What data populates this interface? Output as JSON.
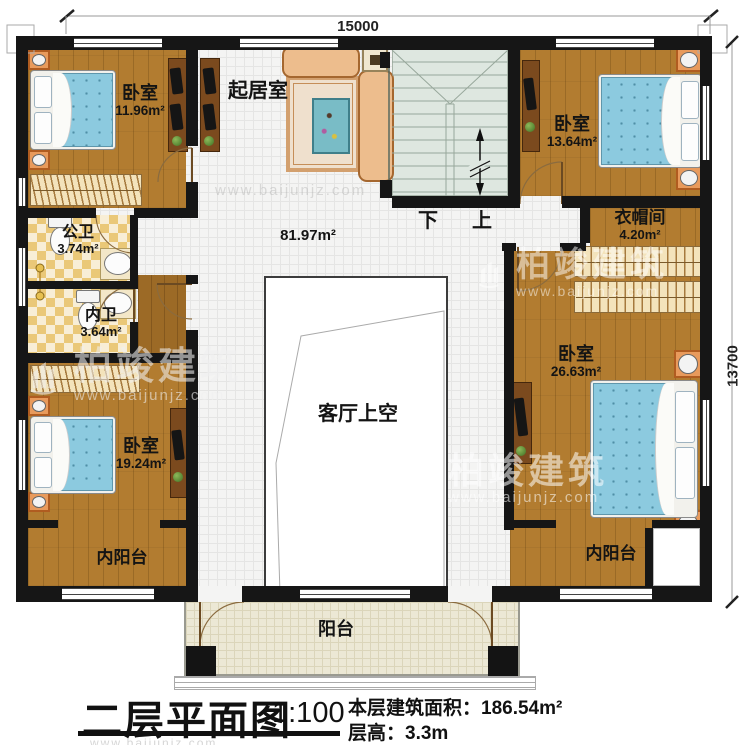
{
  "dimensions": {
    "top": "15000",
    "right": "13700"
  },
  "rooms": {
    "bedroom_top_left": {
      "name": "卧室",
      "area": "11.96m²"
    },
    "living_room": {
      "name": "起居室",
      "area": "81.97m²"
    },
    "bedroom_top_right": {
      "name": "卧室",
      "area": "13.64m²"
    },
    "cloakroom": {
      "name": "衣帽间",
      "area": "4.20m²"
    },
    "public_bathroom": {
      "name": "公卫",
      "area": "3.74m²"
    },
    "private_bathroom": {
      "name": "内卫",
      "area": "3.64m²"
    },
    "bedroom_right": {
      "name": "卧室",
      "area": "26.63m²"
    },
    "bedroom_bottom_left": {
      "name": "卧室",
      "area": "19.24m²"
    },
    "living_void": {
      "name": "客厅上空"
    },
    "inner_balcony_left": {
      "name": "内阳台"
    },
    "inner_balcony_right": {
      "name": "内阳台"
    },
    "balcony": {
      "name": "阳台"
    }
  },
  "stairs": {
    "down_label": "下",
    "up_label": "上"
  },
  "title_block": {
    "title": "二层平面图",
    "scale": "1:100",
    "floor_area_label": "本层建筑面积：",
    "floor_area_value": "186.54m²",
    "floor_height_label": "层高：",
    "floor_height_value": "3.3m"
  },
  "watermark": {
    "brand": "柏竣建筑",
    "url": "www.baijunjz.com"
  },
  "colors": {
    "wall": "#161616",
    "wood": "#b27c30",
    "bed_blue": "#8ccadf",
    "bath_checker": "#eac878",
    "stairs": "#dee7e0",
    "balcony": "#ece8d5"
  }
}
